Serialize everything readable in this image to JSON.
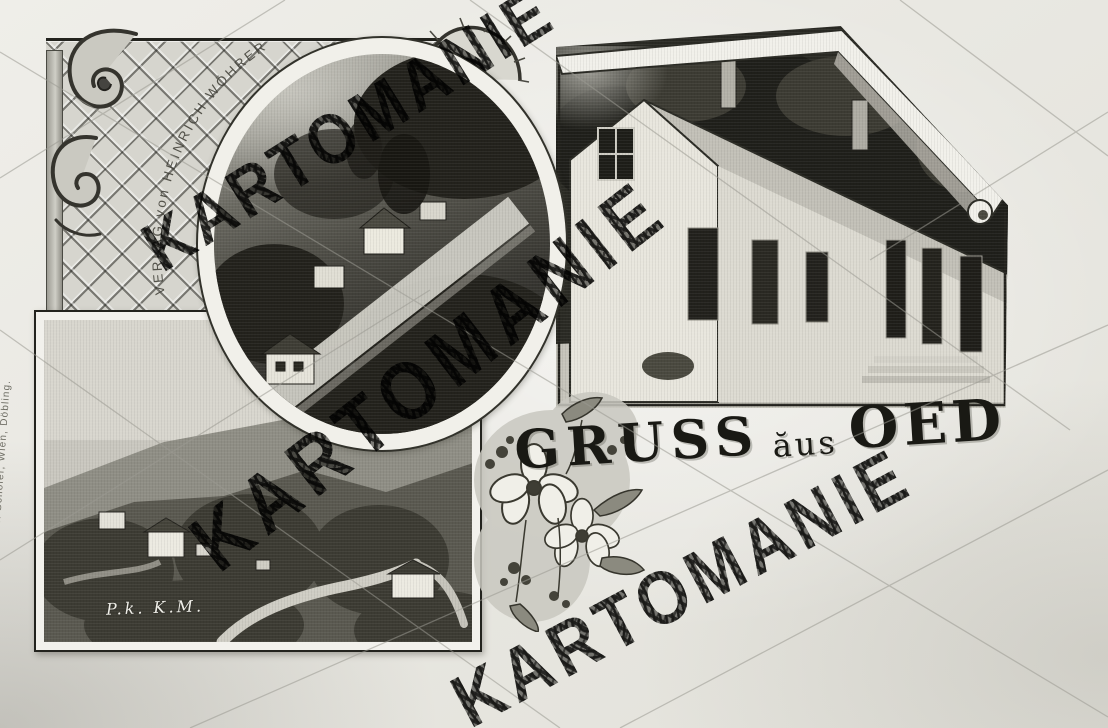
{
  "postcard": {
    "greeting": {
      "gruss": "GRUSS",
      "aus": "ăus",
      "oed": "OED"
    },
    "publisher_arc": "VERLAG von HEINRICH WÖHRER",
    "printer_credit": "Druck v. Fr. Schöler, Wien, Döbling.",
    "photo_signature": "P.k. K.M.",
    "watermark": {
      "instances": [
        "KARTOMANIE",
        "KARTOMANIE",
        "KARTOMANIE"
      ]
    },
    "colors": {
      "paper": "#ecebe6",
      "ink": "#1c1c18",
      "stamp_black": "#121210",
      "photo_dark": "#26251f",
      "photo_light": "#d9d7cf"
    }
  }
}
